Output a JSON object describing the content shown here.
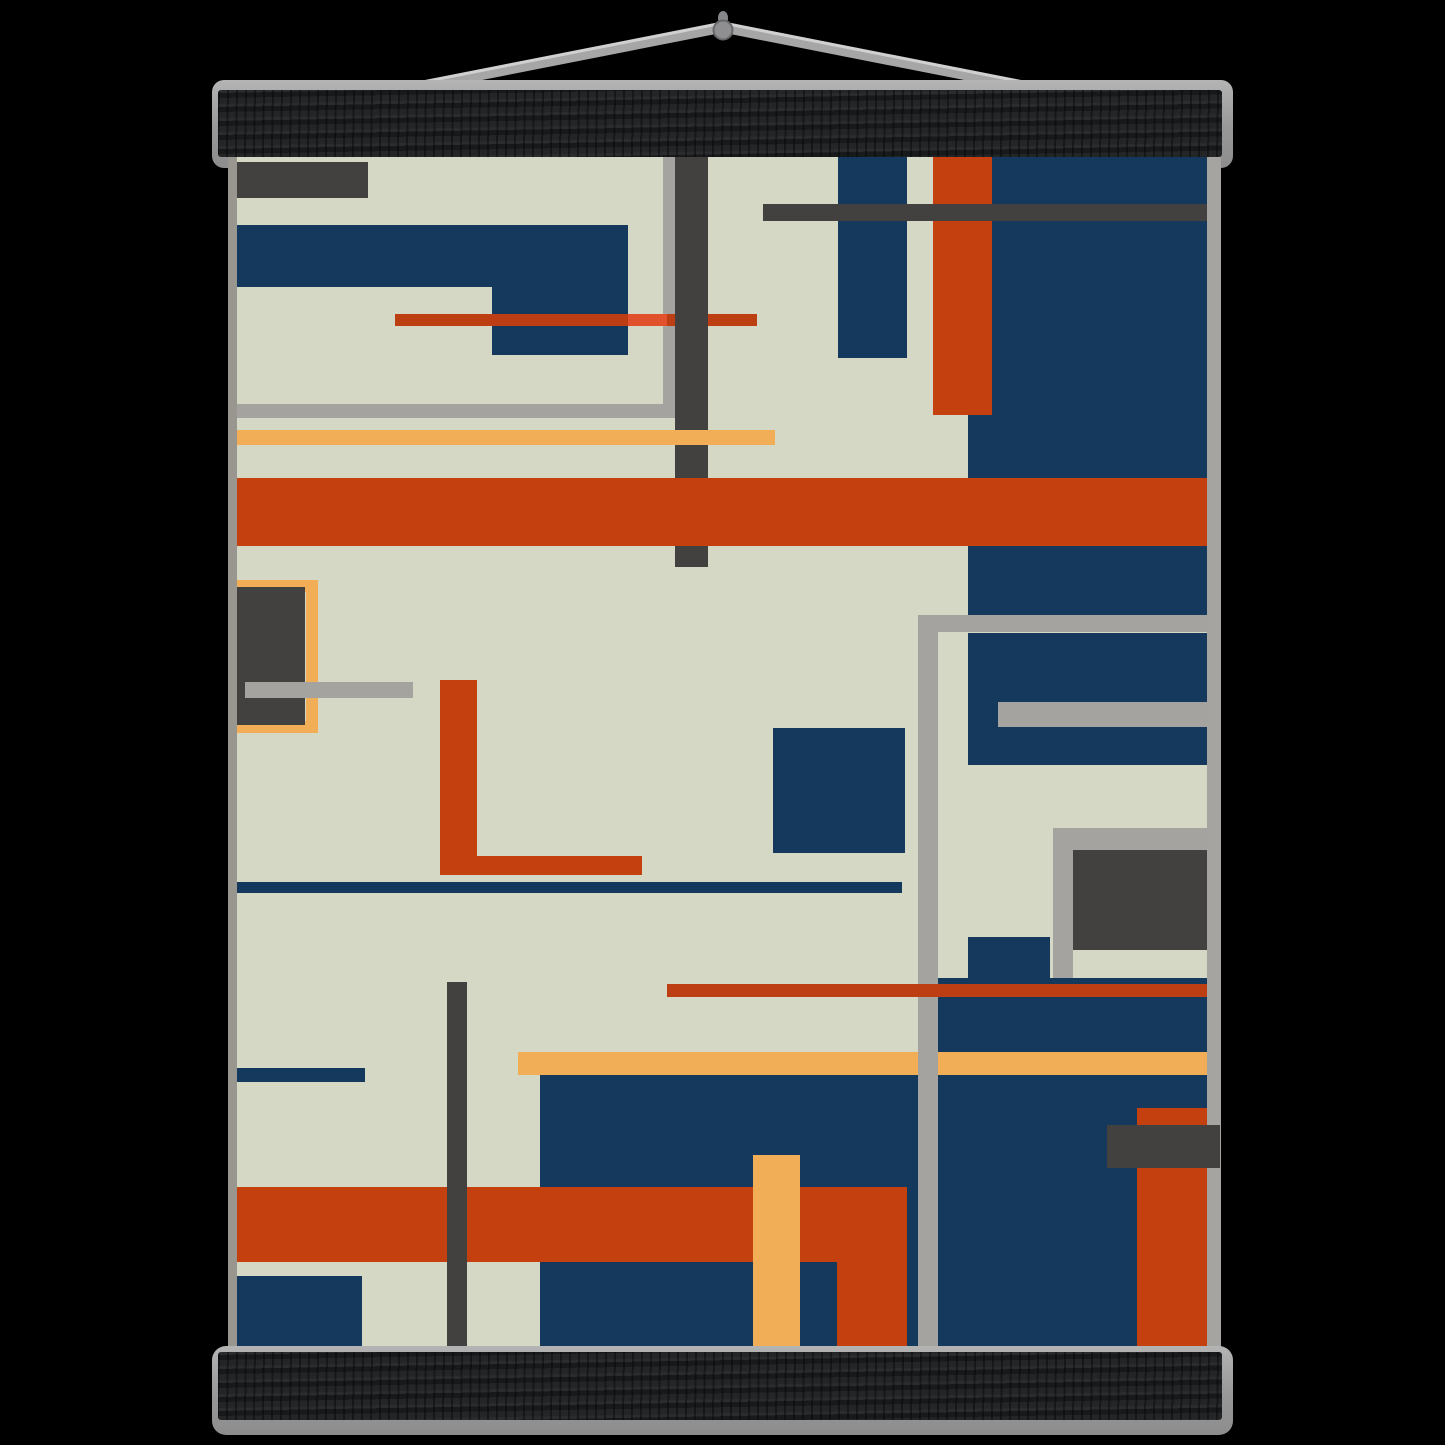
{
  "product": {
    "description": "abstract-geometric-art-poster-with-magnetic-wooden-hangers",
    "background_color": "#000000"
  },
  "hanger": {
    "top_bar_color": "#1e2022",
    "bottom_bar_color": "#1e2022",
    "plate_color": "#9a9a9a",
    "wire_color": "#a6a6a6",
    "wire_highlight_color": "#d0d0d0",
    "pin_color": "#8f8f91",
    "pin_rim_color": "#66686a",
    "wire_apex": {
      "x": 723,
      "y": 27
    },
    "wire_left_end": {
      "x": 423,
      "y": 86
    },
    "wire_right_end": {
      "x": 1023,
      "y": 86
    },
    "pin_center": {
      "x": 723,
      "y": 30
    },
    "pin_radius": 9.5
  },
  "artwork": {
    "palette": {
      "cream": "#d4d8c4",
      "navy": "#14395c",
      "rust": "#c5400f",
      "rustLine": "#bc3e12",
      "rustBright": "#e2512d",
      "peach": "#f2ae57",
      "charcoal": "#434140",
      "silver": "#a5a3a0",
      "edgeLeft": "#98968f",
      "edgeRight": "#a6a4a1"
    },
    "edge_strips": [
      {
        "name": "poster-left-edge-strip",
        "color": "edgeLeft",
        "rect": [
          0,
          0,
          9,
          1195
        ]
      },
      {
        "name": "poster-right-edge-strip",
        "color": "edgeRight",
        "rect": [
          979,
          0,
          14,
          1195
        ]
      }
    ],
    "shapes": [
      {
        "name": "charcoal-rect-top-left",
        "color": "charcoal",
        "rect": [
          9,
          5,
          131,
          36
        ]
      },
      {
        "name": "navy-l-shape-top",
        "color": "navy",
        "rect": [
          9,
          68,
          391,
          62
        ]
      },
      {
        "name": "navy-l-shape-drop",
        "color": "navy",
        "rect": [
          264,
          130,
          136,
          68
        ]
      },
      {
        "name": "silver-outline-left-vertical",
        "color": "silver",
        "rect": [
          435,
          0,
          15,
          261
        ]
      },
      {
        "name": "silver-outline-left-bottom",
        "color": "silver",
        "rect": [
          9,
          247,
          441,
          14
        ]
      },
      {
        "name": "red-thin-line-upper",
        "color": "rustLine",
        "rect": [
          167,
          157,
          362,
          12
        ]
      },
      {
        "name": "red-thin-line-bright-segment",
        "color": "rustBright",
        "rect": [
          400,
          157,
          39,
          12
        ]
      },
      {
        "name": "charcoal-vertical-bar-upper",
        "color": "charcoal",
        "rect": [
          447,
          0,
          33,
          410
        ]
      },
      {
        "name": "peach-band-upper",
        "color": "peach",
        "rect": [
          9,
          273,
          538,
          15
        ]
      },
      {
        "name": "navy-block-top-right",
        "color": "navy",
        "rect": [
          740,
          0,
          239,
          458
        ]
      },
      {
        "name": "navy-vertical-bar-top",
        "color": "navy",
        "rect": [
          610,
          0,
          69,
          201
        ]
      },
      {
        "name": "rust-vertical-bar-top",
        "color": "rust",
        "rect": [
          705,
          0,
          59,
          258
        ]
      },
      {
        "name": "charcoal-horizontal-bar-top",
        "color": "charcoal",
        "rect": [
          535,
          47,
          444,
          17
        ]
      },
      {
        "name": "orange-band-middle",
        "color": "rust",
        "rect": [
          9,
          321,
          970,
          68
        ]
      },
      {
        "name": "peach-outline-rect",
        "color": "peach",
        "rect": [
          9,
          423,
          81,
          153
        ],
        "border": 12
      },
      {
        "name": "charcoal-rect-middle-left",
        "color": "charcoal",
        "rect": [
          9,
          430,
          68,
          138
        ]
      },
      {
        "name": "silver-bar-middle-left",
        "color": "silver",
        "rect": [
          17,
          525,
          168,
          16
        ]
      },
      {
        "name": "rust-l-vertical",
        "color": "rust",
        "rect": [
          212,
          523,
          37,
          195
        ]
      },
      {
        "name": "rust-l-horizontal",
        "color": "rust",
        "rect": [
          212,
          699,
          202,
          19
        ]
      },
      {
        "name": "navy-thin-line-middle",
        "color": "navy",
        "rect": [
          9,
          725,
          665,
          11
        ]
      },
      {
        "name": "navy-square-center",
        "color": "navy",
        "rect": [
          545,
          571,
          132,
          125
        ]
      },
      {
        "name": "navy-block-mid-right",
        "color": "navy",
        "rect": [
          740,
          476,
          239,
          132
        ]
      },
      {
        "name": "silver-bar-inside-navy",
        "color": "silver",
        "rect": [
          770,
          545,
          209,
          25
        ]
      },
      {
        "name": "charcoal-block-right",
        "color": "charcoal",
        "rect": [
          845,
          690,
          134,
          103
        ]
      },
      {
        "name": "silver-outline2-horizontal",
        "color": "silver",
        "rect": [
          825,
          671,
          154,
          22
        ]
      },
      {
        "name": "silver-outline2-vertical",
        "color": "silver",
        "rect": [
          825,
          671,
          20,
          150
        ]
      },
      {
        "name": "navy-small-block-right",
        "color": "navy",
        "rect": [
          740,
          780,
          82,
          41
        ]
      },
      {
        "name": "navy-block-bottom-right",
        "color": "navy",
        "rect": [
          710,
          821,
          269,
          374
        ]
      },
      {
        "name": "navy-block-bottom-center",
        "color": "navy",
        "rect": [
          312,
          918,
          398,
          277
        ]
      },
      {
        "name": "peach-band-lower",
        "color": "peach",
        "rect": [
          290,
          895,
          689,
          23
        ]
      },
      {
        "name": "navy-short-bar-left",
        "color": "navy",
        "rect": [
          9,
          911,
          128,
          14
        ]
      },
      {
        "name": "orange-band-bottom",
        "color": "rust",
        "rect": [
          9,
          1030,
          670,
          75
        ]
      },
      {
        "name": "rust-extension-bottom",
        "color": "rust",
        "rect": [
          609,
          1105,
          70,
          90
        ]
      },
      {
        "name": "peach-vertical-bar-bottom",
        "color": "peach",
        "rect": [
          525,
          998,
          47,
          197
        ]
      },
      {
        "name": "navy-block-bottom-left",
        "color": "navy",
        "rect": [
          9,
          1119,
          125,
          76
        ]
      },
      {
        "name": "charcoal-vertical-bar-lower",
        "color": "charcoal",
        "rect": [
          219,
          825,
          20,
          370
        ]
      },
      {
        "name": "rust-bar-bottom-right",
        "color": "rust",
        "rect": [
          909,
          951,
          70,
          244
        ]
      },
      {
        "name": "charcoal-rect-bottom-right",
        "color": "charcoal",
        "rect": [
          879,
          968,
          113,
          43
        ]
      },
      {
        "name": "silver-outline1-vertical",
        "color": "silver",
        "rect": [
          690,
          458,
          20,
          737
        ]
      },
      {
        "name": "silver-outline1-horizontal",
        "color": "silver",
        "rect": [
          690,
          458,
          289,
          17
        ]
      },
      {
        "name": "rust-thin-line-lower",
        "color": "rustLine",
        "rect": [
          439,
          827,
          540,
          13
        ]
      }
    ]
  }
}
